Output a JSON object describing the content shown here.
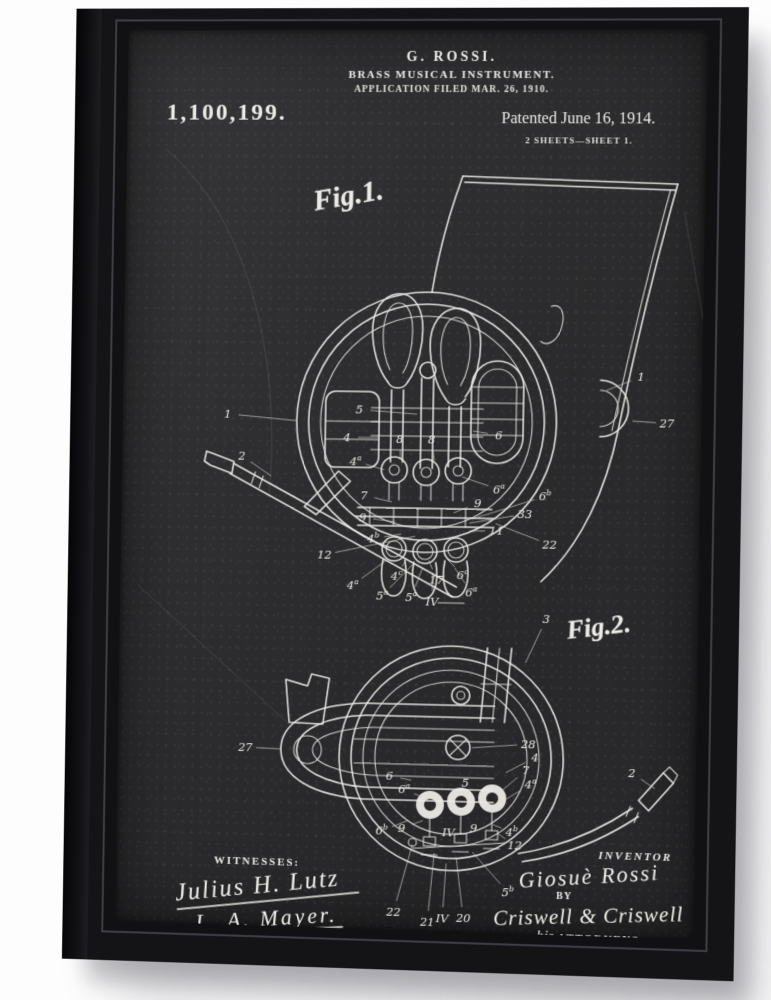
{
  "colors": {
    "background": "#ffffff",
    "frame": "#141417",
    "canvas": "#2c2c2e",
    "chalk": "#eceae6"
  },
  "patent": {
    "header": {
      "inventor_line": "G. ROSSI.",
      "title_line": "BRASS MUSICAL INSTRUMENT.",
      "application_line": "APPLICATION FILED MAR. 26, 1910.",
      "patent_number": "1,100,199.",
      "patented_line": "Patented June 16, 1914.",
      "sheets_line": "2 SHEETS—SHEET 1."
    },
    "figures": [
      {
        "caption": "Fig.1.",
        "labels": [
          {
            "t": "1",
            "x": 107,
            "y": 386,
            "tx": 176,
            "ty": 392
          },
          {
            "t": "2",
            "x": 122,
            "y": 428,
            "tx": 152,
            "ty": 448
          },
          {
            "t": "1",
            "x": 520,
            "y": 344,
            "tx": 486,
            "ty": 358
          },
          {
            "t": "27",
            "x": 546,
            "y": 390,
            "tx": 512,
            "ty": 388
          },
          {
            "t": "5",
            "x": 240,
            "y": 380,
            "tx": 298,
            "ty": 384
          },
          {
            "t": "4",
            "x": 228,
            "y": 408,
            "tx": 260,
            "ty": 408
          },
          {
            "t": "6",
            "x": 380,
            "y": 404,
            "tx": 354,
            "ty": 400
          },
          {
            "t": "8",
            "x": 281,
            "y": 409,
            "tx": 282,
            "ty": 430
          },
          {
            "t": "8",
            "x": 313,
            "y": 409,
            "tx": 316,
            "ty": 430
          },
          {
            "t": "4a",
            "x": 237,
            "y": 432,
            "tx": 266,
            "ty": 440
          },
          {
            "t": "7",
            "x": 246,
            "y": 466,
            "tx": 274,
            "ty": 472
          },
          {
            "t": "9",
            "x": 245,
            "y": 488,
            "tx": 278,
            "ty": 492
          },
          {
            "t": "4b",
            "x": 256,
            "y": 509,
            "tx": 284,
            "ty": 504
          },
          {
            "t": "12",
            "x": 207,
            "y": 526,
            "tx": 298,
            "ty": 506
          },
          {
            "t": "6a",
            "x": 381,
            "y": 458,
            "tx": 344,
            "ty": 446
          },
          {
            "t": "9",
            "x": 360,
            "y": 472,
            "tx": 336,
            "ty": 482
          },
          {
            "t": "6b",
            "x": 427,
            "y": 464,
            "tx": 354,
            "ty": 488
          },
          {
            "t": "33",
            "x": 407,
            "y": 482,
            "tx": 352,
            "ty": 492
          },
          {
            "t": "11",
            "x": 379,
            "y": 499,
            "tx": 352,
            "ty": 500
          },
          {
            "t": "22",
            "x": 432,
            "y": 512,
            "tx": 378,
            "ty": 492
          },
          {
            "t": "4a",
            "x": 236,
            "y": 556,
            "tx": 270,
            "ty": 530
          },
          {
            "t": "4c",
            "x": 280,
            "y": 546,
            "tx": 290,
            "ty": 528
          },
          {
            "t": "17",
            "x": 320,
            "y": 549,
            "tx": 312,
            "ty": 530
          },
          {
            "t": "6c",
            "x": 346,
            "y": 544,
            "tx": 330,
            "ty": 528
          },
          {
            "t": "5b",
            "x": 266,
            "y": 566,
            "tx": 296,
            "ty": 534
          },
          {
            "t": "5a",
            "x": 295,
            "y": 567,
            "tx": 306,
            "ty": 537
          },
          {
            "t": "IV",
            "x": 316,
            "y": 571,
            "tx": 316,
            "ty": 542
          },
          {
            "t": "6a",
            "x": 355,
            "y": 561,
            "tx": 338,
            "ty": 537
          }
        ]
      },
      {
        "caption": "Fig.2.",
        "labels": [
          {
            "t": "27",
            "x": 130,
            "y": 721,
            "tx": 166,
            "ty": 722
          },
          {
            "t": "3",
            "x": 430,
            "y": 586,
            "tx": 410,
            "ty": 630
          },
          {
            "t": "28",
            "x": 414,
            "y": 711,
            "tx": 358,
            "ty": 716
          },
          {
            "t": "4",
            "x": 421,
            "y": 724,
            "tx": 392,
            "ty": 740
          },
          {
            "t": "7",
            "x": 412,
            "y": 737,
            "tx": 384,
            "ty": 762
          },
          {
            "t": "4a",
            "x": 417,
            "y": 751,
            "tx": 390,
            "ty": 768
          },
          {
            "t": "5",
            "x": 352,
            "y": 751,
            "tx": 344,
            "ty": 762
          },
          {
            "t": "6",
            "x": 276,
            "y": 746,
            "tx": 298,
            "ty": 750
          },
          {
            "t": "6a",
            "x": 291,
            "y": 759,
            "tx": 308,
            "ty": 766
          },
          {
            "t": "6b",
            "x": 269,
            "y": 801,
            "tx": 296,
            "ty": 790
          },
          {
            "t": "9",
            "x": 289,
            "y": 798,
            "tx": 310,
            "ty": 790
          },
          {
            "t": "IV",
            "x": 336,
            "y": 801,
            "tx": 336,
            "ty": 790
          },
          {
            "t": "9",
            "x": 361,
            "y": 796,
            "tx": 356,
            "ty": 790
          },
          {
            "t": "4b",
            "x": 399,
            "y": 799,
            "tx": 380,
            "ty": 792
          },
          {
            "t": "12",
            "x": 402,
            "y": 812,
            "tx": 384,
            "ty": 800
          },
          {
            "t": "5b",
            "x": 396,
            "y": 859,
            "tx": 360,
            "ty": 820
          },
          {
            "t": "22",
            "x": 282,
            "y": 882,
            "tx": 300,
            "ty": 814
          },
          {
            "t": "21",
            "x": 316,
            "y": 891,
            "tx": 322,
            "ty": 822
          },
          {
            "t": "IV",
            "x": 331,
            "y": 887,
            "tx": 334,
            "ty": 832
          },
          {
            "t": "20",
            "x": 352,
            "y": 886,
            "tx": 344,
            "ty": 826
          },
          {
            "t": "2",
            "x": 517,
            "y": 737,
            "tx": 540,
            "ty": 752
          }
        ]
      }
    ],
    "signatures": {
      "witnesses_heading": "WITNESSES:",
      "witness_1": "Julius H. Lutz",
      "witness_2": "L. A. Mayer.",
      "inventor_heading": "INVENTOR",
      "inventor_name": "Giosuè Rossi",
      "by_label": "BY",
      "attorneys_name": "Criswell & Criswell",
      "attorneys_prefix": "his",
      "attorneys_label": "ATTORNEYS"
    }
  }
}
